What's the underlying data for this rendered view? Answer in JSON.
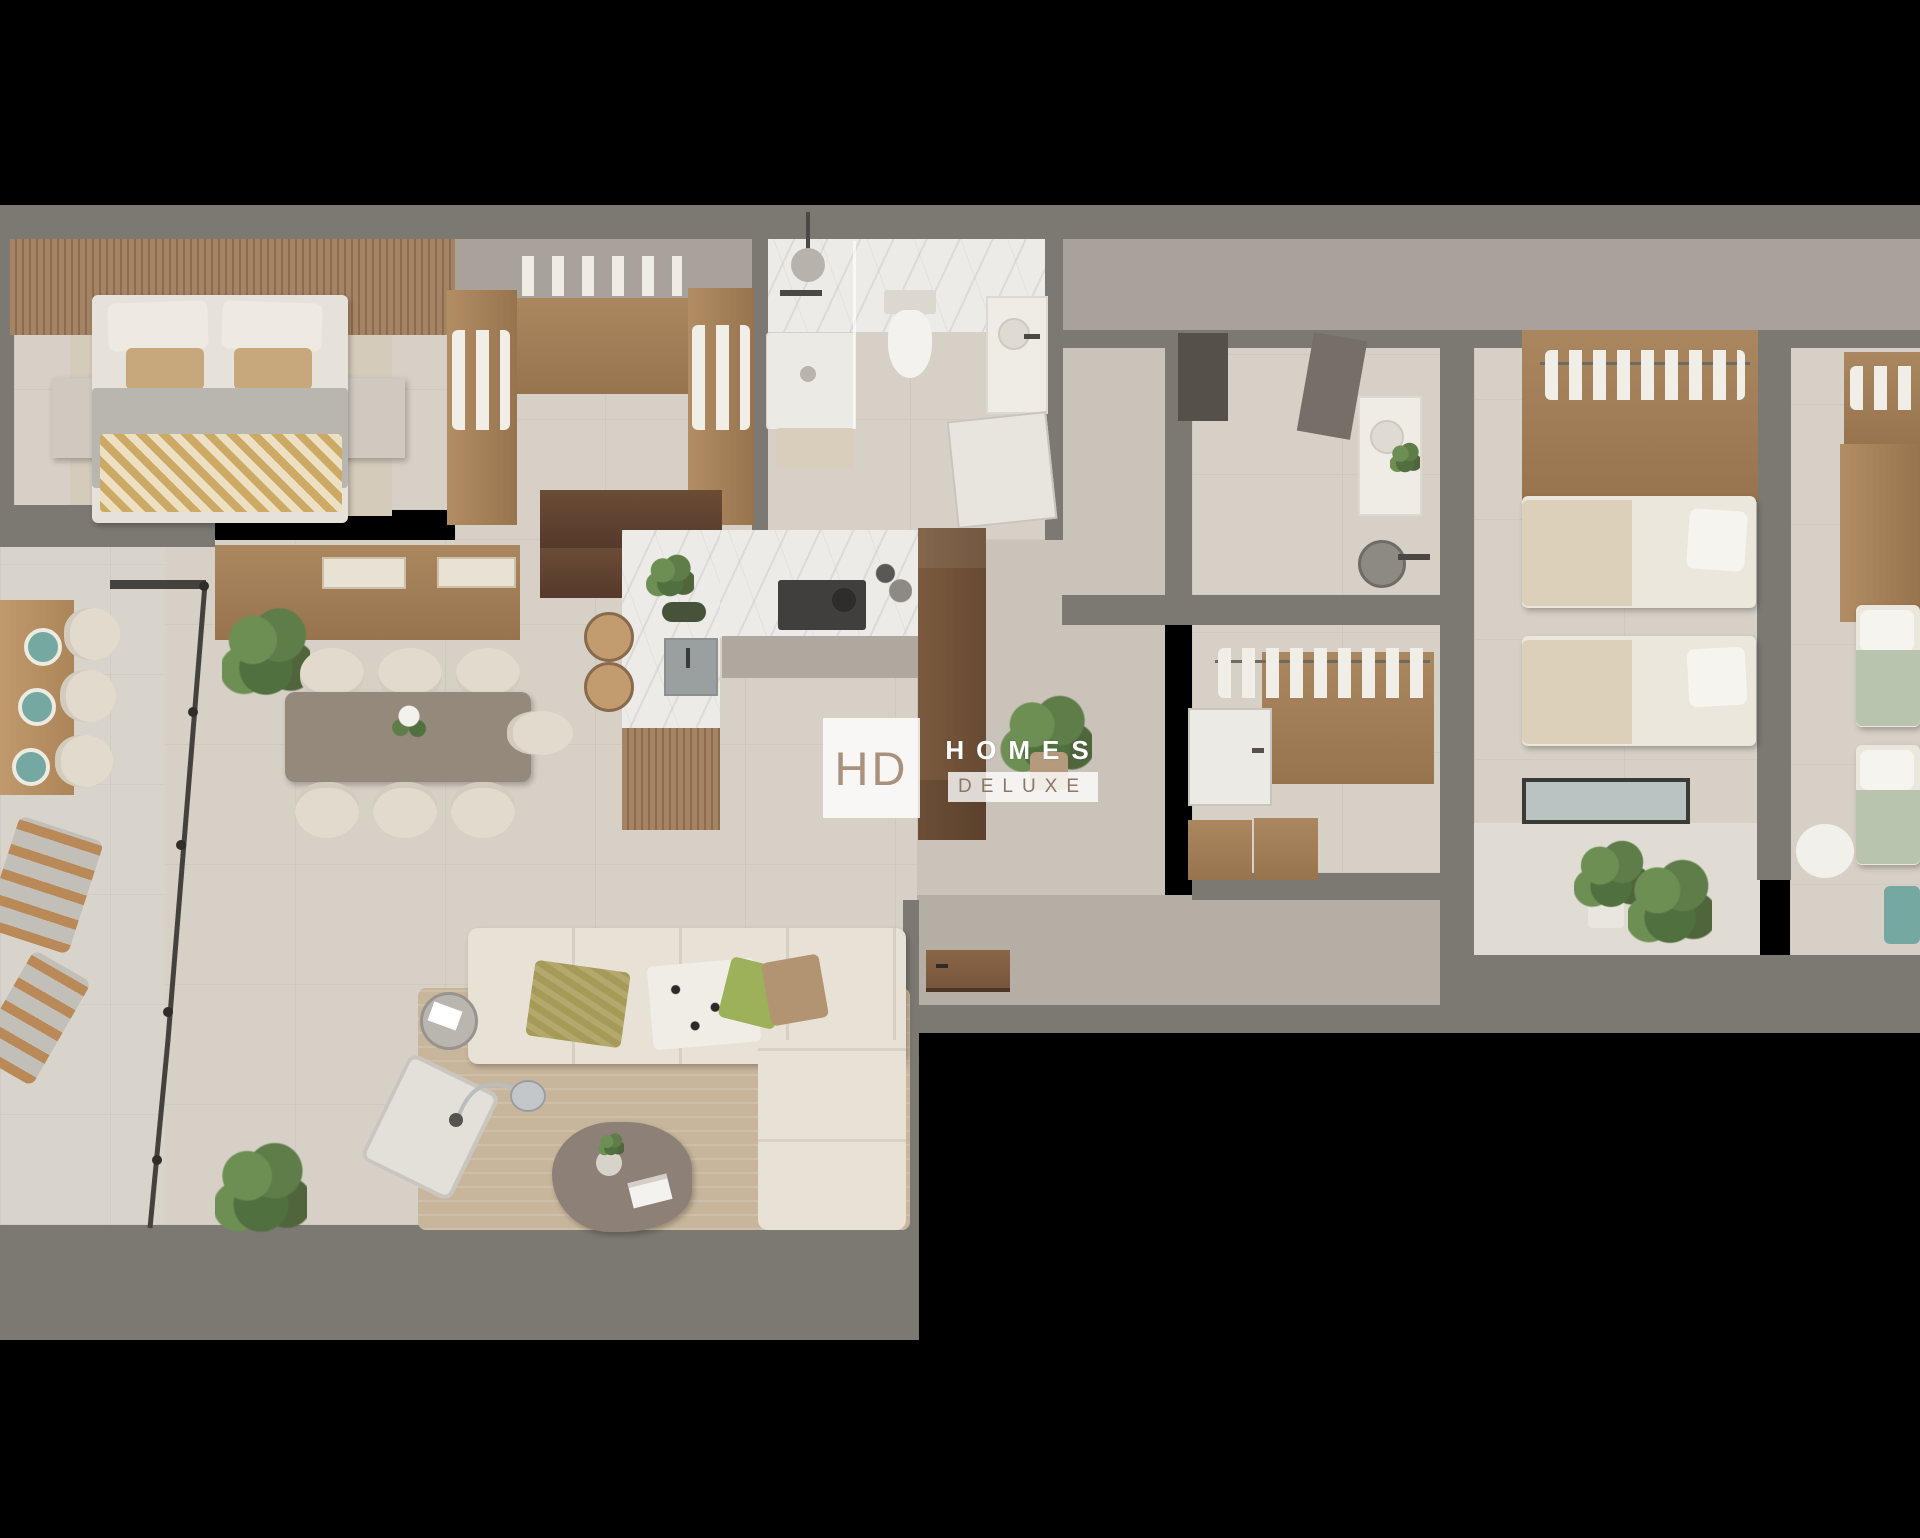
{
  "watermark": {
    "initials": "HD",
    "line1": "HOMES",
    "line2": "DELUXE"
  },
  "colors": {
    "background": "#000000",
    "wall_gray": "#7c7872",
    "wall_zone": "#a8a29a",
    "floor_tile": "#d6d0c6",
    "floor_warm": "#c9c3ba",
    "corridor_floor": "#b4aea5",
    "terrace_floor": "#d9d4cb",
    "balcony_floor": "#e0dcd4",
    "marble_white": "#edebe7",
    "wood_oak": "#ab8760",
    "wood_walnut": "#5f4431",
    "wood_light": "#c09a6d",
    "cabinet_taupe": "#b0a89f",
    "sofa_cream": "#e8e1d5",
    "duvet_gray": "#b9b5af",
    "rug_tan": "#c8b69c",
    "table_taupe": "#95897b",
    "chair_cream": "#e2dbcd",
    "hob_dark": "#403f3d",
    "plant_green": "#5e7d49",
    "accent_teal": "#76a8a2",
    "pillow_olive": "#a59a58",
    "pillow_green": "#9cb159",
    "pillow_brown": "#b29372",
    "glass_frame": "#45423d",
    "watermark_tan": "#a8917e",
    "watermark_brown": "#8b7767"
  },
  "regions": [
    "master-bedroom",
    "walk-in-closet",
    "ensuite-bathroom",
    "kitchen",
    "dining-area",
    "living-room",
    "terrace",
    "entry-hall",
    "corridor",
    "second-bathroom",
    "dressing-room",
    "bedroom-2",
    "balcony",
    "bedroom-3"
  ]
}
